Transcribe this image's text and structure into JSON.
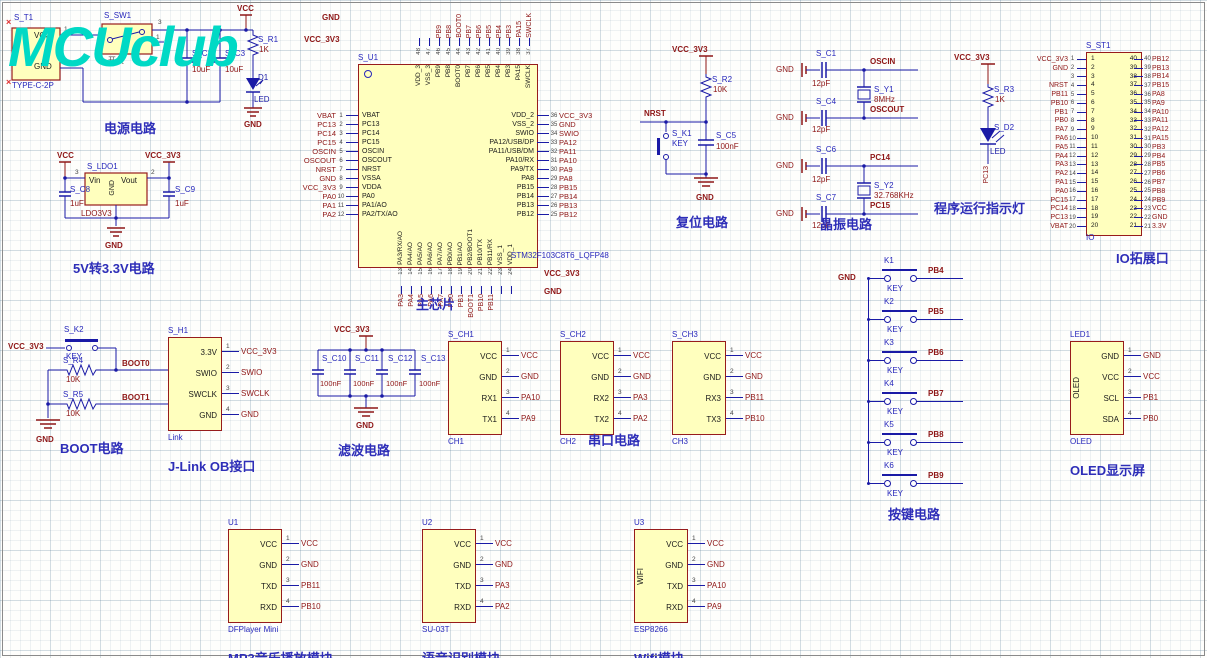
{
  "logo": "MCUclub",
  "power": {
    "title": "电源电路",
    "t1_des": "S_T1",
    "t1_part": "TYPE-C-2P",
    "t1_p1": "VCC",
    "t1_p2": "GND",
    "n1": "1",
    "n2": "2",
    "sw_des": "S_SW1",
    "sw_label": "开关",
    "sw_p3": "3",
    "sw_p1": "1",
    "c2_des": "S_C2",
    "c2_val": "10uF",
    "c3_des": "S_C3",
    "c3_val": "10uF",
    "r1_des": "S_R1",
    "r1_val": "1K",
    "d1_des": "D1",
    "d1_val": "LED",
    "vcc": "VCC",
    "gnd": "GND",
    "x": "×"
  },
  "ldo": {
    "title": "5V转3.3V电路",
    "des": "S_LDO1",
    "part": "LDO3V3",
    "vin": "Vin",
    "vout": "Vout",
    "gnd_pin": "GND",
    "p3": "3",
    "p2": "2",
    "c8_des": "S_C8",
    "c8_val": "1uF",
    "c9_des": "S_C9",
    "c9_val": "1uF",
    "vcc": "VCC",
    "vcc33": "VCC_3V3",
    "gnd": "GND"
  },
  "chip": {
    "title": "主芯片",
    "des": "S_U1",
    "part": "STM32F103C8T6_LQFP48",
    "top_gnd": "GND",
    "top_vcc": "VCC_3V3",
    "bot_vcc": "VCC_3V3",
    "bot_gnd": "GND",
    "left": [
      {
        "num": "1",
        "name": "VBAT",
        "net": "VBAT"
      },
      {
        "num": "2",
        "name": "PC13",
        "net": "PC13"
      },
      {
        "num": "3",
        "name": "PC14",
        "net": "PC14"
      },
      {
        "num": "4",
        "name": "PC15",
        "net": "PC15"
      },
      {
        "num": "5",
        "name": "OSCIN",
        "net": "OSCIN"
      },
      {
        "num": "6",
        "name": "OSCOUT",
        "net": "OSCOUT"
      },
      {
        "num": "7",
        "name": "NRST",
        "net": "NRST"
      },
      {
        "num": "8",
        "name": "VSSA",
        "net": "GND"
      },
      {
        "num": "9",
        "name": "VDDA",
        "net": "VCC_3V3"
      },
      {
        "num": "10",
        "name": "PA0",
        "net": "PA0"
      },
      {
        "num": "11",
        "name": "PA1/AO",
        "net": "PA1"
      },
      {
        "num": "12",
        "name": "PA2/TX/AO",
        "net": "PA2"
      }
    ],
    "right": [
      {
        "num": "36",
        "name": "VDD_2",
        "net": "VCC_3V3"
      },
      {
        "num": "35",
        "name": "VSS_2",
        "net": "GND"
      },
      {
        "num": "34",
        "name": "SWIO",
        "net": "SWIO"
      },
      {
        "num": "33",
        "name": "PA12/USB/DP",
        "net": "PA12"
      },
      {
        "num": "32",
        "name": "PA11/USB/DM",
        "net": "PA11"
      },
      {
        "num": "31",
        "name": "PA10/RX",
        "net": "PA10"
      },
      {
        "num": "30",
        "name": "PA9/TX",
        "net": "PA9"
      },
      {
        "num": "29",
        "name": "PA8",
        "net": "PA8"
      },
      {
        "num": "28",
        "name": "PB15",
        "net": "PB15"
      },
      {
        "num": "27",
        "name": "PB14",
        "net": "PB14"
      },
      {
        "num": "26",
        "name": "PB13",
        "net": "PB13"
      },
      {
        "num": "25",
        "name": "PB12",
        "net": "PB12"
      }
    ],
    "top": [
      {
        "num": "48",
        "name": "VDD_3",
        "net": ""
      },
      {
        "num": "47",
        "name": "VSS_3",
        "net": ""
      },
      {
        "num": "46",
        "name": "PB9",
        "net": "PB9"
      },
      {
        "num": "45",
        "name": "PB8",
        "net": "PB8"
      },
      {
        "num": "44",
        "name": "BOOT0",
        "net": "BOOT0"
      },
      {
        "num": "43",
        "name": "PB7",
        "net": "PB7"
      },
      {
        "num": "42",
        "name": "PB6",
        "net": "PB6"
      },
      {
        "num": "41",
        "name": "PB5",
        "net": "PB5"
      },
      {
        "num": "40",
        "name": "PB4",
        "net": "PB4"
      },
      {
        "num": "39",
        "name": "PB3",
        "net": "PB3"
      },
      {
        "num": "38",
        "name": "PA15",
        "net": "PA15"
      },
      {
        "num": "37",
        "name": "SWCLK",
        "net": "SWCLK"
      }
    ],
    "bottom": [
      {
        "num": "13",
        "name": "PA3/RX/AO",
        "net": "PA3"
      },
      {
        "num": "14",
        "name": "PA4/AO",
        "net": "PA4"
      },
      {
        "num": "15",
        "name": "PA5/AO",
        "net": "PA5"
      },
      {
        "num": "16",
        "name": "PA6/AO",
        "net": "PA6"
      },
      {
        "num": "17",
        "name": "PA7/AO",
        "net": "PA7"
      },
      {
        "num": "18",
        "name": "PB0/AO",
        "net": "PB0"
      },
      {
        "num": "19",
        "name": "PB1/AO",
        "net": "PB1"
      },
      {
        "num": "20",
        "name": "PB2/BOOT1",
        "net": "BOOT1"
      },
      {
        "num": "21",
        "name": "PB10/TX",
        "net": "PB10"
      },
      {
        "num": "22",
        "name": "PB11/RX",
        "net": "PB11"
      },
      {
        "num": "23",
        "name": "VSS_1",
        "net": ""
      },
      {
        "num": "24",
        "name": "VDD_1",
        "net": ""
      }
    ]
  },
  "reset": {
    "title": "复位电路",
    "vcc": "VCC_3V3",
    "r_des": "S_R2",
    "r_val": "10K",
    "net": "NRST",
    "k_des": "S_K1",
    "k_val": "KEY",
    "c_des": "S_C5",
    "c_val": "100nF",
    "gnd": "GND"
  },
  "xtal": {
    "title": "晶振电路",
    "groups": [
      {
        "c1": "S_C1",
        "v1": "12pF",
        "n1": "OSCIN",
        "y": "S_Y1",
        "f": "8MHz",
        "c2": "S_C4",
        "v2": "12pF",
        "n2": "OSCOUT",
        "g1": "GND",
        "g2": "GND"
      },
      {
        "c1": "S_C6",
        "v1": "12pF",
        "n1": "PC14",
        "y": "S_Y2",
        "f": "32.768KHz",
        "c2": "S_C7",
        "v2": "12pF",
        "n2": "PC15",
        "g1": "GND",
        "g2": "GND"
      }
    ]
  },
  "led": {
    "title": "程序运行指示灯",
    "vcc": "VCC_3V3",
    "r_des": "S_R3",
    "r_val": "1K",
    "d_des": "S_D2",
    "d_val": "LED",
    "net": "PC13"
  },
  "io": {
    "title": "IO拓展口",
    "des": "S_ST1",
    "foot": "IO",
    "left": [
      {
        "num": "1",
        "net": "VCC_3V3"
      },
      {
        "num": "2",
        "net": "GND"
      },
      {
        "num": "3",
        "net": ""
      },
      {
        "num": "4",
        "net": "NRST"
      },
      {
        "num": "5",
        "net": "PB11"
      },
      {
        "num": "6",
        "net": "PB10"
      },
      {
        "num": "7",
        "net": "PB1"
      },
      {
        "num": "8",
        "net": "PB0"
      },
      {
        "num": "9",
        "net": "PA7"
      },
      {
        "num": "10",
        "net": "PA6"
      },
      {
        "num": "11",
        "net": "PA5"
      },
      {
        "num": "12",
        "net": "PA4"
      },
      {
        "num": "13",
        "net": "PA3"
      },
      {
        "num": "14",
        "net": "PA2"
      },
      {
        "num": "15",
        "net": "PA1"
      },
      {
        "num": "16",
        "net": "PA0"
      },
      {
        "num": "17",
        "net": "PC15"
      },
      {
        "num": "18",
        "net": "PC14"
      },
      {
        "num": "19",
        "net": "PC13"
      },
      {
        "num": "20",
        "net": "VBAT"
      }
    ],
    "right": [
      {
        "num": "40",
        "net": "PB12"
      },
      {
        "num": "39",
        "net": "PB13"
      },
      {
        "num": "38",
        "net": "PB14"
      },
      {
        "num": "37",
        "net": "PB15"
      },
      {
        "num": "36",
        "net": "PA8"
      },
      {
        "num": "35",
        "net": "PA9"
      },
      {
        "num": "34",
        "net": "PA10"
      },
      {
        "num": "33",
        "net": "PA11"
      },
      {
        "num": "32",
        "net": "PA12"
      },
      {
        "num": "31",
        "net": "PA15"
      },
      {
        "num": "30",
        "net": "PB3"
      },
      {
        "num": "29",
        "net": "PB4"
      },
      {
        "num": "28",
        "net": "PB5"
      },
      {
        "num": "27",
        "net": "PB6"
      },
      {
        "num": "26",
        "net": "PB7"
      },
      {
        "num": "25",
        "net": "PB8"
      },
      {
        "num": "24",
        "net": "PB9"
      },
      {
        "num": "23",
        "net": "VCC"
      },
      {
        "num": "22",
        "net": "GND"
      },
      {
        "num": "21",
        "net": "3.3V"
      }
    ]
  },
  "boot": {
    "title": "BOOT电路",
    "vcc": "VCC_3V3",
    "k_des": "S_K2",
    "k_val": "KEY",
    "r4_des": "S_R4",
    "r4_val": "10K",
    "r5_des": "S_R5",
    "r5_val": "10K",
    "net0": "BOOT0",
    "net1": "BOOT1",
    "gnd": "GND"
  },
  "jlink": {
    "title": "J-Link OB接口",
    "des": "S_H1",
    "foot": "Link",
    "side": "",
    "pins": [
      {
        "name": "3.3V",
        "num": "1",
        "net": "VCC_3V3"
      },
      {
        "name": "SWIO",
        "num": "2",
        "net": "SWIO"
      },
      {
        "name": "SWCLK",
        "num": "3",
        "net": "SWCLK"
      },
      {
        "name": "GND",
        "num": "4",
        "net": "GND"
      }
    ]
  },
  "filter": {
    "title": "滤波电路",
    "vcc": "VCC_3V3",
    "gnd": "GND",
    "caps": [
      {
        "des": "S_C10",
        "val": "100nF"
      },
      {
        "des": "S_C11",
        "val": "100nF"
      },
      {
        "des": "S_C12",
        "val": "100nF"
      },
      {
        "des": "S_C13",
        "val": "100nF"
      }
    ]
  },
  "serial_title": "串口电路",
  "ch1": {
    "title": "",
    "des": "S_CH1",
    "foot": "CH1",
    "side": "",
    "pins": [
      {
        "name": "VCC",
        "num": "1",
        "net": "VCC"
      },
      {
        "name": "GND",
        "num": "2",
        "net": "GND"
      },
      {
        "name": "RX1",
        "num": "3",
        "net": "PA10"
      },
      {
        "name": "TX1",
        "num": "4",
        "net": "PA9"
      }
    ]
  },
  "ch2": {
    "title": "",
    "des": "S_CH2",
    "foot": "CH2",
    "side": "",
    "pins": [
      {
        "name": "VCC",
        "num": "1",
        "net": "VCC"
      },
      {
        "name": "GND",
        "num": "2",
        "net": "GND"
      },
      {
        "name": "RX2",
        "num": "3",
        "net": "PA3"
      },
      {
        "name": "TX2",
        "num": "4",
        "net": "PA2"
      }
    ]
  },
  "ch3": {
    "title": "",
    "des": "S_CH3",
    "foot": "CH3",
    "side": "",
    "pins": [
      {
        "name": "VCC",
        "num": "1",
        "net": "VCC"
      },
      {
        "name": "GND",
        "num": "2",
        "net": "GND"
      },
      {
        "name": "RX3",
        "num": "3",
        "net": "PB11"
      },
      {
        "name": "TX3",
        "num": "4",
        "net": "PB10"
      }
    ]
  },
  "keys": {
    "title": "按键电路",
    "gnd": "GND",
    "items": [
      {
        "ref": "K1",
        "key": "KEY",
        "net": "PB4"
      },
      {
        "ref": "K2",
        "key": "KEY",
        "net": "PB5"
      },
      {
        "ref": "K3",
        "key": "KEY",
        "net": "PB6"
      },
      {
        "ref": "K4",
        "key": "KEY",
        "net": "PB7"
      },
      {
        "ref": "K5",
        "key": "KEY",
        "net": "PB8"
      },
      {
        "ref": "K6",
        "key": "KEY",
        "net": "PB9"
      }
    ]
  },
  "oled": {
    "title": "OLED显示屏",
    "des": "LED1",
    "foot": "OLED",
    "side": "OLED",
    "pins": [
      {
        "name": "GND",
        "num": "1",
        "net": "GND"
      },
      {
        "name": "VCC",
        "num": "2",
        "net": "VCC"
      },
      {
        "name": "SCL",
        "num": "3",
        "net": "PB1"
      },
      {
        "name": "SDA",
        "num": "4",
        "net": "PB0"
      }
    ]
  },
  "mp3": {
    "title": "MP3音乐播放模块",
    "des": "U1",
    "foot": "DFPlayer Mini",
    "side": "",
    "pins": [
      {
        "name": "VCC",
        "num": "1",
        "net": "VCC"
      },
      {
        "name": "GND",
        "num": "2",
        "net": "GND"
      },
      {
        "name": "TXD",
        "num": "3",
        "net": "PB11"
      },
      {
        "name": "RXD",
        "num": "4",
        "net": "PB10"
      }
    ]
  },
  "voice": {
    "title": "语音识别模块",
    "des": "U2",
    "foot": "SU-03T",
    "side": "",
    "pins": [
      {
        "name": "VCC",
        "num": "1",
        "net": "VCC"
      },
      {
        "name": "GND",
        "num": "2",
        "net": "GND"
      },
      {
        "name": "TXD",
        "num": "3",
        "net": "PA3"
      },
      {
        "name": "RXD",
        "num": "4",
        "net": "PA2"
      }
    ]
  },
  "wifi": {
    "title": "Wifi模块",
    "des": "U3",
    "foot": "ESP8266",
    "side": "WIFI",
    "pins": [
      {
        "name": "VCC",
        "num": "1",
        "net": "VCC"
      },
      {
        "name": "GND",
        "num": "2",
        "net": "GND"
      },
      {
        "name": "TXD",
        "num": "3",
        "net": "PA10"
      },
      {
        "name": "RXD",
        "num": "4",
        "net": "PA9"
      }
    ]
  }
}
